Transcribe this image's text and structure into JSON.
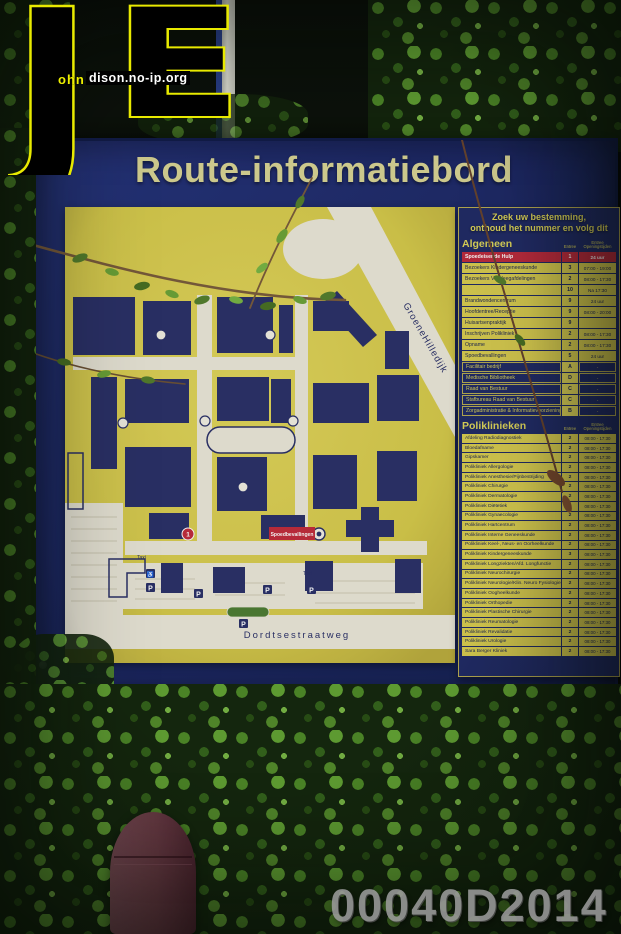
{
  "watermark": {
    "logo_letter_j": "J",
    "logo_letter_e": "E",
    "logo_text_ohn": "ohn",
    "logo_text_site": "dison.no-ip.org",
    "photo_id": "00040D2014"
  },
  "sign": {
    "title": "Route-informatiebord",
    "map": {
      "street_diagonal": "GroeneHilledijk",
      "street_bottom": "Dordtsestraatweg",
      "red_label": "Spoedbevallingen",
      "marker_red": "1",
      "parking_label": "P",
      "wheelchair_symbol": "♿",
      "taxi_label": "Taxi"
    },
    "panel": {
      "instruction_line1": "Zoek uw bestemming,",
      "instruction_line2": "onthoud het nummer en volg dit",
      "col_entree": "Entree",
      "col_open": "Entree\nOpeningstijden",
      "algemeen": {
        "heading": "Algemeen",
        "rows": [
          {
            "label": "Spoedeisende Hulp",
            "entree": "1",
            "tijden": "24 uur",
            "style": "red"
          },
          {
            "label": "Bezoekers Kindergeneeskunde",
            "entree": "3",
            "tijden": "07:00 - 19:00"
          },
          {
            "label": "Bezoekers Verpleegafdelingen",
            "entree": "2",
            "tijden": "08:00 - 17:30"
          },
          {
            "label": "",
            "entree": "10",
            "tijden": "Na 17:30"
          },
          {
            "label": "Brandwondencentrum",
            "entree": "9",
            "tijden": "24 uur"
          },
          {
            "label": "Hoofdentree/Receptie",
            "entree": "9",
            "tijden": "08:00 - 20:00"
          },
          {
            "label": "Huisartsenpraktijk",
            "entree": "9",
            "tijden": ""
          },
          {
            "label": "Inschrijven Polikliniek",
            "entree": "2",
            "tijden": "08:00 - 17:30"
          },
          {
            "label": "Opname",
            "entree": "2",
            "tijden": "08:00 - 17:30"
          },
          {
            "label": "Spoedbevallingen",
            "entree": "5",
            "tijden": "24 uur"
          },
          {
            "label": "Facilitair bedrijf",
            "entree": "A",
            "tijden": "-",
            "style": "blue"
          },
          {
            "label": "Medische Bibliotheek",
            "entree": "D",
            "tijden": "-",
            "style": "blue"
          },
          {
            "label": "Raad van Bestuur",
            "entree": "C",
            "tijden": "-",
            "style": "blue"
          },
          {
            "label": "Stafbureau Raad van Bestuur",
            "entree": "C",
            "tijden": "-",
            "style": "blue"
          },
          {
            "label": "Zorgadministratie & Informatievoorziening",
            "entree": "B",
            "tijden": "-",
            "style": "blue"
          }
        ]
      },
      "poliklinieken": {
        "heading": "Poliklinieken",
        "rows": [
          {
            "label": "Afdeling Radiodiagnostiek",
            "entree": "2",
            "tijden": "08:00 - 17:30"
          },
          {
            "label": "Bloedafname",
            "entree": "2",
            "tijden": "08:00 - 17:30"
          },
          {
            "label": "Gipskamer",
            "entree": "2",
            "tijden": "08:00 - 17:30"
          },
          {
            "label": "Polikliniek Allergologie",
            "entree": "2",
            "tijden": "08:00 - 17:30"
          },
          {
            "label": "Polikliniek Anesthesie/Pijnbestrijding",
            "entree": "2",
            "tijden": "08:00 - 17:30"
          },
          {
            "label": "Polikliniek Chirurgie",
            "entree": "2",
            "tijden": "08:00 - 17:30"
          },
          {
            "label": "Polikliniek Dermatologie",
            "entree": "2",
            "tijden": "08:00 - 17:30"
          },
          {
            "label": "Polikliniek Diëtetiek",
            "entree": "2",
            "tijden": "08:00 - 17:30"
          },
          {
            "label": "Polikliniek Gynaecologie",
            "entree": "2",
            "tijden": "08:00 - 17:30"
          },
          {
            "label": "Polikliniek Hartcentrum",
            "entree": "2",
            "tijden": "08:00 - 17:30"
          },
          {
            "label": "Polikliniek Interne Geneeskunde",
            "entree": "2",
            "tijden": "08:00 - 17:30"
          },
          {
            "label": "Polikliniek Keel-, Neus- en Oorheelkunde",
            "entree": "2",
            "tijden": "08:00 - 17:30"
          },
          {
            "label": "Polikliniek Kindergeneeskunde",
            "entree": "3",
            "tijden": "08:00 - 17:30"
          },
          {
            "label": "Polikliniek Longziekten/Afd. Longfunctie",
            "entree": "2",
            "tijden": "08:00 - 17:30"
          },
          {
            "label": "Polikliniek Neurochirurgie",
            "entree": "2",
            "tijden": "08:00 - 17:30"
          },
          {
            "label": "Polikliniek Neurologie/Klin. Neuro Fysiologie",
            "entree": "2",
            "tijden": "08:00 - 17:30"
          },
          {
            "label": "Polikliniek Oogheelkunde",
            "entree": "2",
            "tijden": "08:00 - 17:30"
          },
          {
            "label": "Polikliniek Orthopedie",
            "entree": "2",
            "tijden": "08:00 - 17:30"
          },
          {
            "label": "Polikliniek Plastische Chirurgie",
            "entree": "2",
            "tijden": "08:00 - 17:30"
          },
          {
            "label": "Polikliniek Reumatologie",
            "entree": "2",
            "tijden": "08:00 - 17:30"
          },
          {
            "label": "Polikliniek Revalidatie",
            "entree": "2",
            "tijden": "08:00 - 17:30"
          },
          {
            "label": "Polikliniek Urologie",
            "entree": "2",
            "tijden": "08:00 - 17:30"
          },
          {
            "label": "Sara Berger Kliniek",
            "entree": "2",
            "tijden": "08:00 - 17:30"
          }
        ]
      }
    }
  }
}
